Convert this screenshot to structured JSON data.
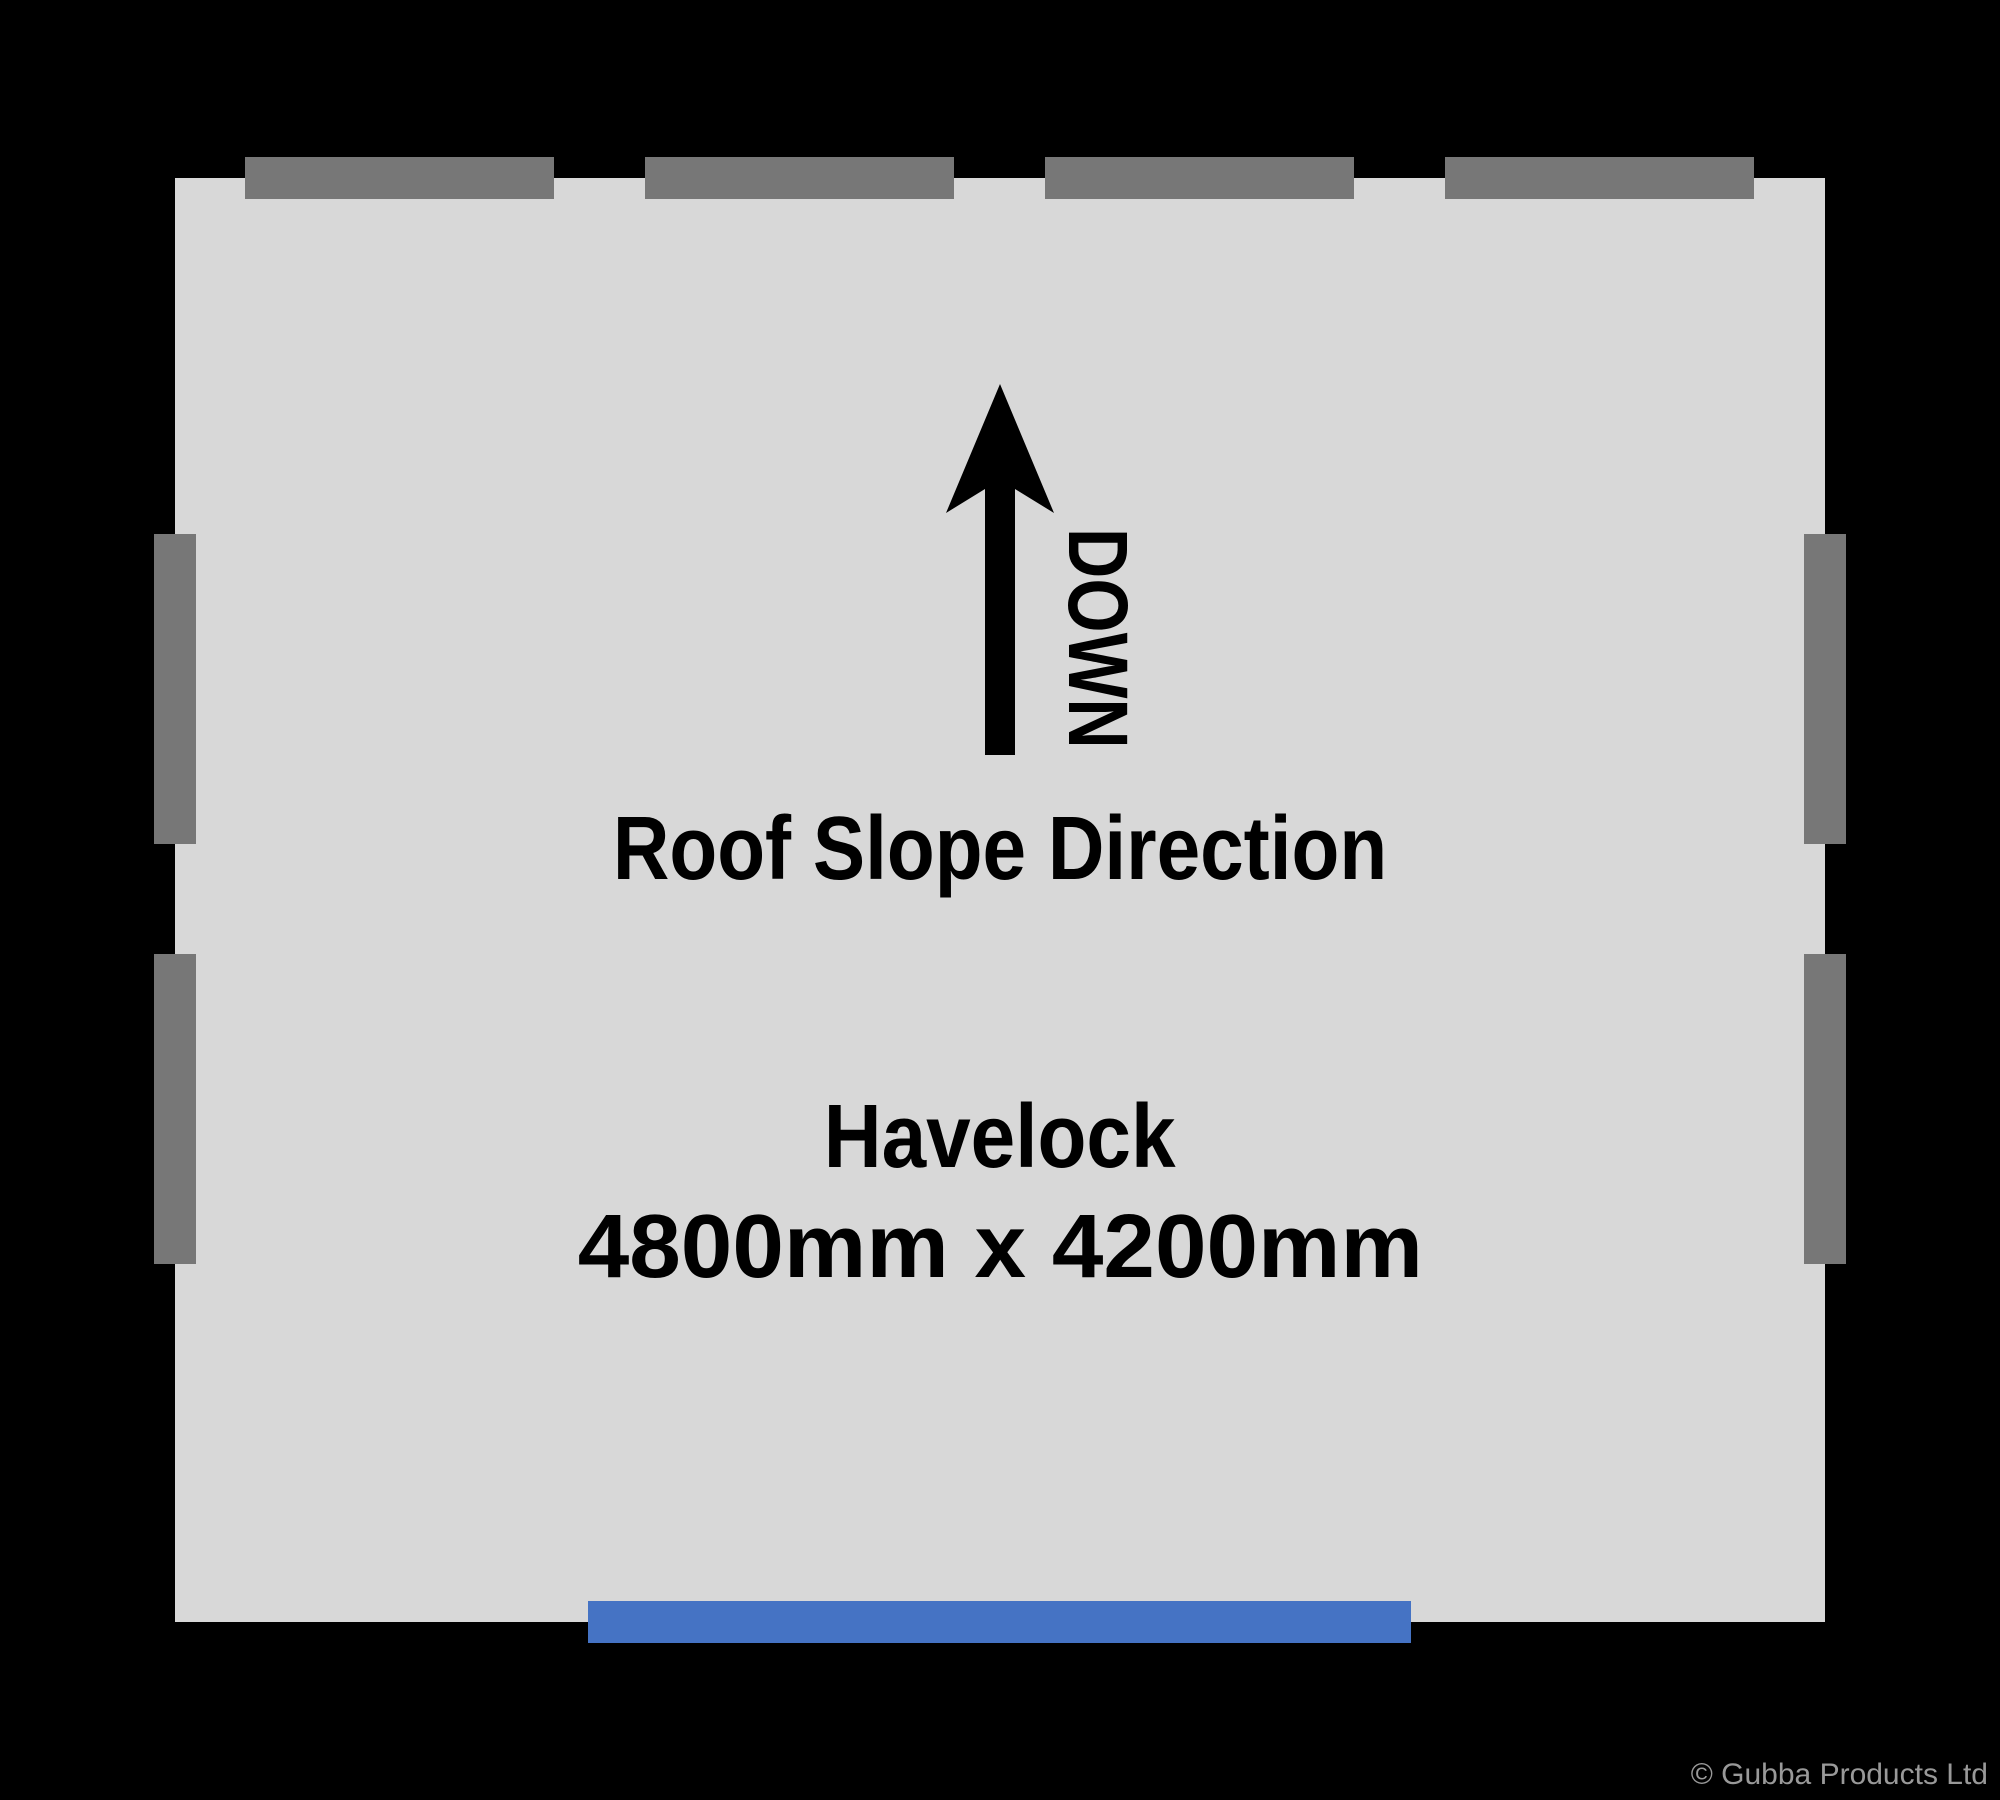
{
  "colors": {
    "background": "#000000",
    "plan_fill": "#D8D8D8",
    "window_gray": "#777777",
    "door_blue": "#4573C4",
    "text_black": "#000000",
    "copyright_gray": "#999999"
  },
  "plan": {
    "outline": {
      "x": 175,
      "y": 178,
      "w": 1650,
      "h": 1444
    },
    "openings": [
      {
        "name": "window-top-1",
        "x": 245,
        "y": 157,
        "w": 309,
        "h": 42,
        "color": "window_gray"
      },
      {
        "name": "window-top-2",
        "x": 645,
        "y": 157,
        "w": 309,
        "h": 42,
        "color": "window_gray"
      },
      {
        "name": "window-top-3",
        "x": 1045,
        "y": 157,
        "w": 309,
        "h": 42,
        "color": "window_gray"
      },
      {
        "name": "window-top-4",
        "x": 1445,
        "y": 157,
        "w": 309,
        "h": 42,
        "color": "window_gray"
      },
      {
        "name": "window-left-1",
        "x": 154,
        "y": 534,
        "w": 42,
        "h": 310,
        "color": "window_gray"
      },
      {
        "name": "window-left-2",
        "x": 154,
        "y": 954,
        "w": 42,
        "h": 310,
        "color": "window_gray"
      },
      {
        "name": "window-right-1",
        "x": 1804,
        "y": 534,
        "w": 42,
        "h": 310,
        "color": "window_gray"
      },
      {
        "name": "window-right-2",
        "x": 1804,
        "y": 954,
        "w": 42,
        "h": 310,
        "color": "window_gray"
      },
      {
        "name": "door-front",
        "x": 588,
        "y": 1601,
        "w": 823,
        "h": 42,
        "color": "door_blue"
      }
    ]
  },
  "annotation": {
    "down_label": "DOWN",
    "roof_slope_label": "Roof Slope Direction"
  },
  "product": {
    "name": "Havelock",
    "dimensions": "4800mm x 4200mm"
  },
  "footer": {
    "copyright": "© Gubba Products Ltd"
  }
}
